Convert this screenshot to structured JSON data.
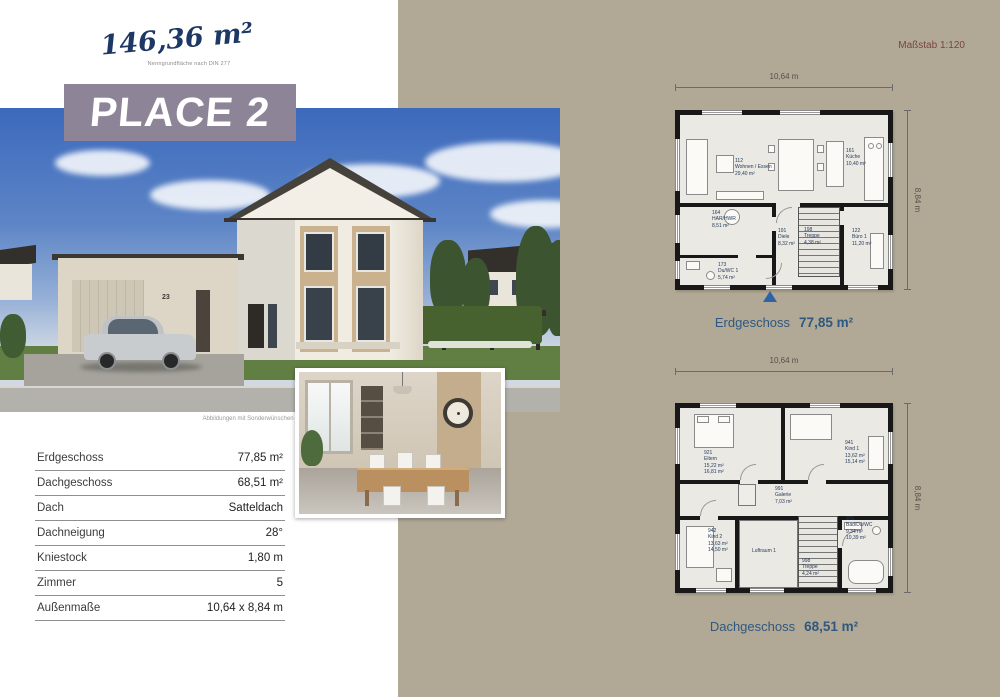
{
  "colors": {
    "accent_beige": "#b1a996",
    "title_purple": "#8d8497",
    "plan_caption_blue": "#2f5880",
    "scale_maroon": "#7a453c",
    "script_navy": "#1d3865"
  },
  "header": {
    "area_handwritten": "146,36 m²",
    "area_note": "Nenngrundfläche nach DIN 277",
    "title": "PLACE 2",
    "scale": "Maßstab 1:120"
  },
  "photo": {
    "house_number": "23",
    "caption": "Abbildungen mit Sonderwünschen"
  },
  "spec_table": {
    "rows": [
      {
        "label": "Erdgeschoss",
        "value": "77,85 m²"
      },
      {
        "label": "Dachgeschoss",
        "value": "68,51 m²"
      },
      {
        "label": "Dach",
        "value": "Satteldach"
      },
      {
        "label": "Dachneigung",
        "value": "28°"
      },
      {
        "label": "Kniestock",
        "value": "1,80 m"
      },
      {
        "label": "Zimmer",
        "value": "5"
      },
      {
        "label": "Außenmaße",
        "value": "10,64 x 8,84 m"
      }
    ]
  },
  "plans": {
    "eg": {
      "caption": "Erdgeschoss",
      "area": "77,85 m²",
      "dim_w": "10,64 m",
      "dim_h": "8,84 m",
      "rooms": [
        {
          "num": "112",
          "name": "Wohnen / Essen",
          "a1": "29,40 m²"
        },
        {
          "num": "161",
          "name": "Küche",
          "a1": "10,40 m²"
        },
        {
          "num": "164",
          "name": "HAR/HWR",
          "a1": "8,51 m²"
        },
        {
          "num": "191",
          "name": "Diele",
          "a1": "8,32 m²"
        },
        {
          "num": "198",
          "name": "Treppe",
          "a1": "4,38 m²"
        },
        {
          "num": "122",
          "name": "Büro 1",
          "a1": "11,20 m²"
        },
        {
          "num": "173",
          "name": "Du/WC 1",
          "a1": "5,74 m²"
        }
      ]
    },
    "dg": {
      "caption": "Dachgeschoss",
      "area": "68,51 m²",
      "dim_w": "10,64 m",
      "dim_h": "8,84 m",
      "rooms": [
        {
          "num": "921",
          "name": "Eltern",
          "a1": "15,22 m²",
          "a2": "16,81 m²"
        },
        {
          "num": "941",
          "name": "Kind 1",
          "a1": "13,62 m²",
          "a2": "15,14 m²"
        },
        {
          "num": "991",
          "name": "Galerie",
          "a1": "7,03 m²"
        },
        {
          "num": "942",
          "name": "Kind 2",
          "a1": "13,63 m²",
          "a2": "14,50 m²"
        },
        {
          "num": "",
          "name": "Luftraum 1",
          "a1": ""
        },
        {
          "num": "998",
          "name": "Treppe",
          "a1": "4,24 m²"
        },
        {
          "num": "971",
          "name": "Bad/Du/WC",
          "a1": "9,34 m²",
          "a2": "10,39 m²"
        }
      ]
    }
  }
}
